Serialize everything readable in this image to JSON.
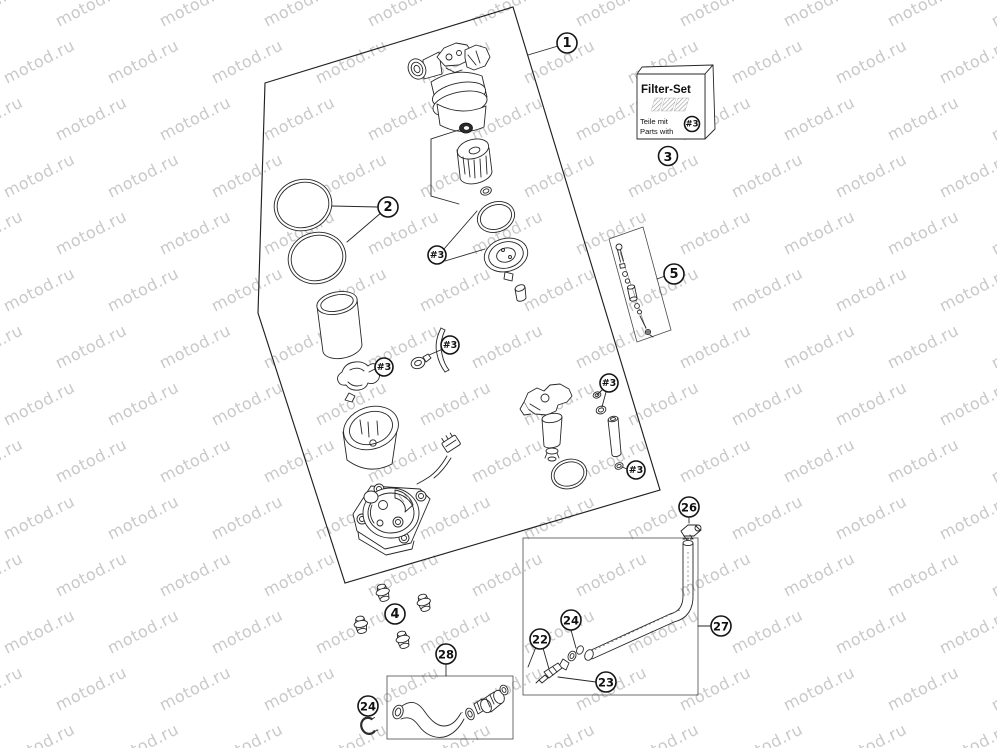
{
  "watermark": {
    "text": "motod.ru",
    "color": "#c9c9c9",
    "rotation": -27,
    "font_size": 16,
    "col_spacing": 104,
    "row_spacing": 57,
    "row_offset": 52,
    "cols": 11,
    "rows": 14,
    "x_start": -45,
    "y_start": 27
  },
  "filter_set_box": {
    "title": "Filter-Set",
    "line1": "Teile mit",
    "line2": "Parts with",
    "badge": "#3",
    "logo": "ktm-logo"
  },
  "callouts": [
    {
      "label": "1",
      "x": 567,
      "y": 43,
      "r": 10,
      "fs": 13
    },
    {
      "label": "2",
      "x": 388,
      "y": 207,
      "r": 10,
      "fs": 13
    },
    {
      "label": "3",
      "x": 668,
      "y": 156,
      "r": 9.5,
      "fs": 12.5
    },
    {
      "label": "4",
      "x": 395,
      "y": 614,
      "r": 10,
      "fs": 13
    },
    {
      "label": "5",
      "x": 674,
      "y": 274,
      "r": 10,
      "fs": 13
    },
    {
      "label": "22",
      "x": 540,
      "y": 639,
      "r": 10,
      "fs": 11.5
    },
    {
      "label": "23",
      "x": 606,
      "y": 682,
      "r": 10,
      "fs": 11.5
    },
    {
      "label": "24",
      "x": 571,
      "y": 620,
      "r": 10,
      "fs": 11.5
    },
    {
      "label": "24",
      "x": 368,
      "y": 706,
      "r": 10,
      "fs": 11.5
    },
    {
      "label": "26",
      "x": 689,
      "y": 507,
      "r": 10,
      "fs": 11.5
    },
    {
      "label": "27",
      "x": 721,
      "y": 626,
      "r": 10,
      "fs": 11.5
    },
    {
      "label": "28",
      "x": 446,
      "y": 654,
      "r": 10,
      "fs": 11.5
    },
    {
      "label": "#3",
      "x": 437,
      "y": 255,
      "r": 9,
      "fs": 9.5
    },
    {
      "label": "#3",
      "x": 384,
      "y": 367,
      "r": 9,
      "fs": 9.5
    },
    {
      "label": "#3",
      "x": 450,
      "y": 345,
      "r": 9,
      "fs": 9.5
    },
    {
      "label": "#3",
      "x": 609,
      "y": 383,
      "r": 9,
      "fs": 9.5
    },
    {
      "label": "#3",
      "x": 636,
      "y": 470,
      "r": 9,
      "fs": 9.5
    },
    {
      "label": "#3",
      "x": 692,
      "y": 124,
      "r": 7.5,
      "fs": 8.5
    }
  ]
}
